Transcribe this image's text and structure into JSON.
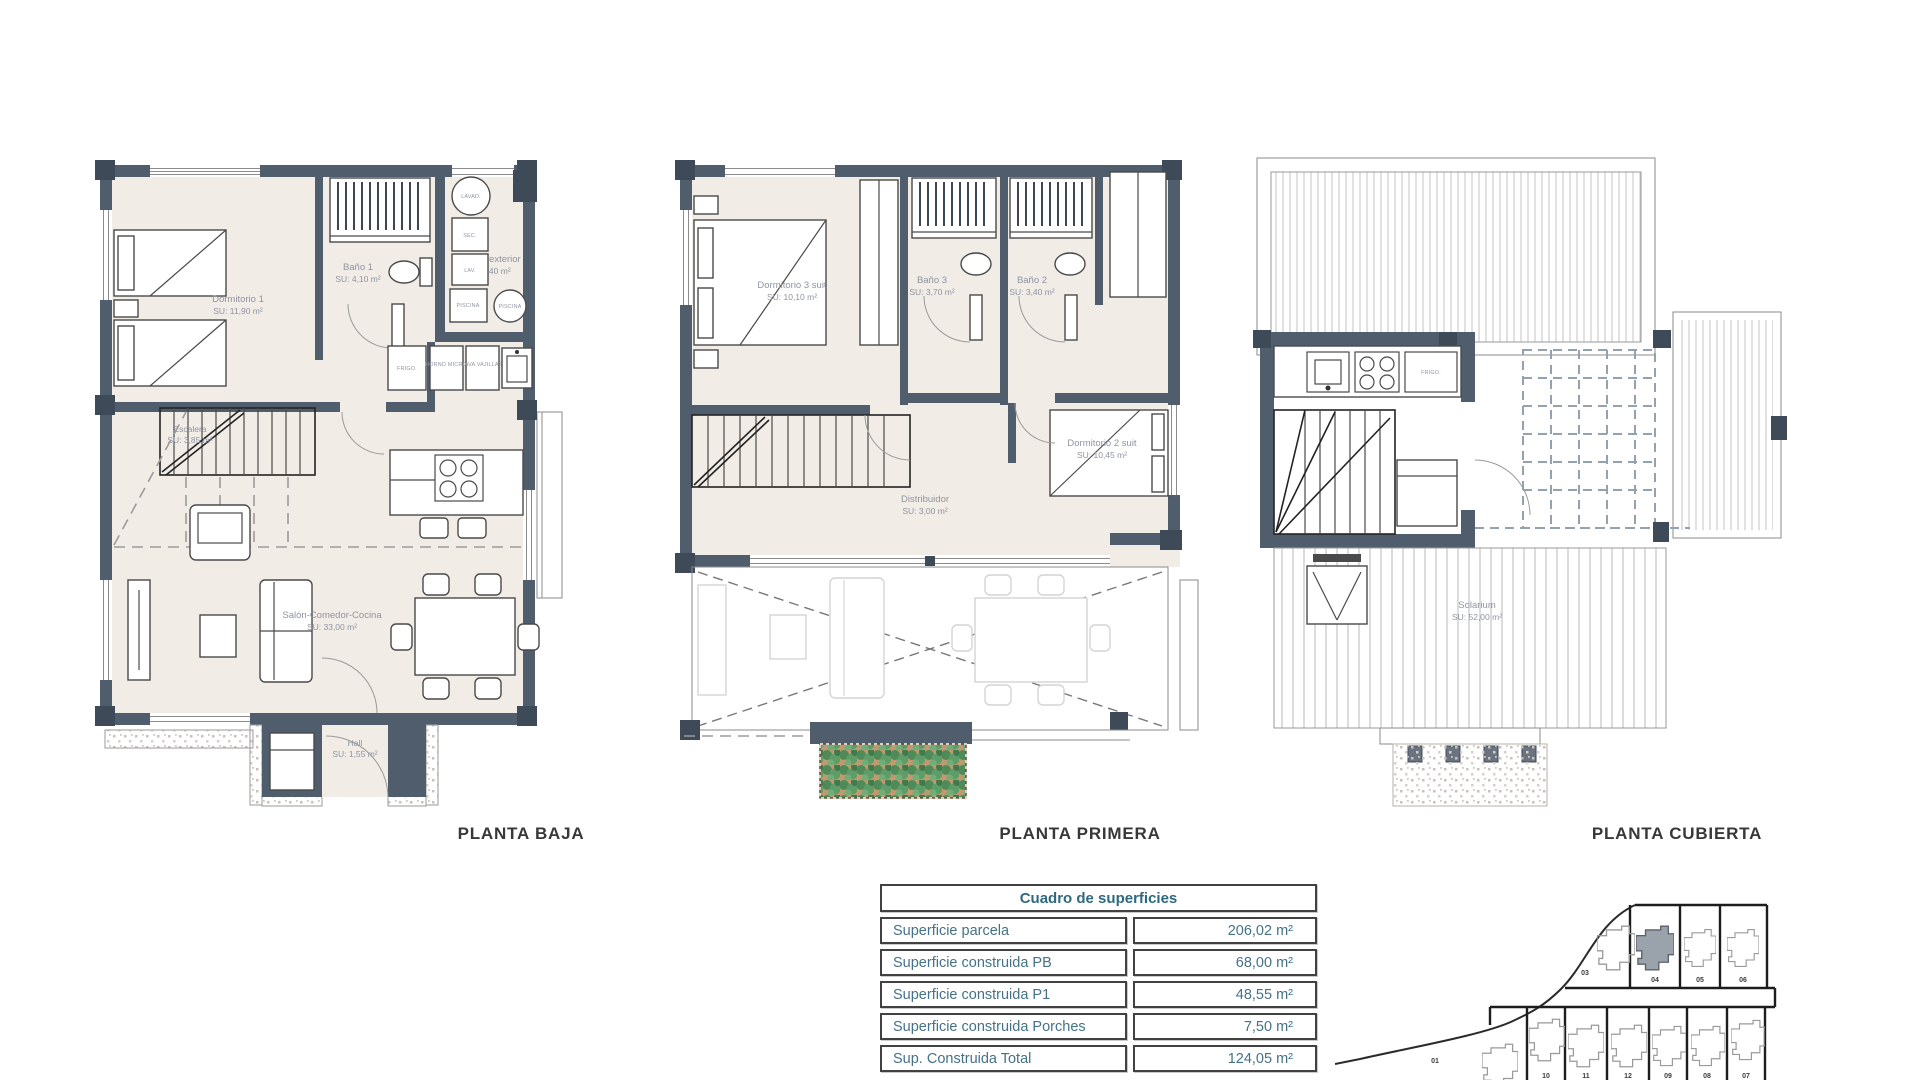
{
  "document_title": "Floor plan sheet",
  "colors": {
    "wall": "#505d6c",
    "floor": "#f2ece7",
    "table_text": "#457285",
    "table_header_text": "#2e6a7e",
    "title_text": "#383838",
    "room_label_text": "#8e94a2",
    "plant_green": "#4f8a59",
    "planter_soil": "#c1996f",
    "highlight_plot": "#9aa2ac"
  },
  "plans": [
    {
      "id": "planta-baja",
      "title": "PLANTA BAJA",
      "rooms": [
        {
          "name": "Dormitorio 1",
          "area": "SU: 11,90 m²"
        },
        {
          "name": "Baño 1",
          "area": "SU: 4,10 m²"
        },
        {
          "name": "Galería exterior",
          "area": "SU: 3,40 m²"
        },
        {
          "name": "Escalera",
          "area": "SU: 3,85 m²"
        },
        {
          "name": "Salón-Comedor-Cocina",
          "area": "SU: 33,00 m²"
        },
        {
          "name": "Hall",
          "area": "SU: 1,55 m²"
        }
      ],
      "labels": {
        "frigo": "FRIGO.",
        "horno": "HORNO MICRO",
        "lavavajillas": "LAVA VAJILLAS",
        "lavadora": "LAVAD.",
        "secadora": "SEC.",
        "lav": "LAV.",
        "piscina1": "PISCINA",
        "piscina2": "PISCINA"
      }
    },
    {
      "id": "planta-primera",
      "title": "PLANTA PRIMERA",
      "rooms": [
        {
          "name": "Dormitorio 3 suit",
          "area": "SU: 10,10 m²"
        },
        {
          "name": "Baño 3",
          "area": "SU: 3,70 m²"
        },
        {
          "name": "Baño 2",
          "area": "SU: 3,40 m²"
        },
        {
          "name": "Dormitorio 2 suit",
          "area": "SU: 10,45 m²"
        },
        {
          "name": "Distribuidor",
          "area": "SU: 3,00 m²"
        }
      ]
    },
    {
      "id": "planta-cubierta",
      "title": "PLANTA CUBIERTA",
      "rooms": [
        {
          "name": "Solarium",
          "area": "SU: 52,00 m²"
        }
      ],
      "labels": {
        "frigo": "FRIGO."
      }
    }
  ],
  "surfaces_table": {
    "header": "Cuadro de superficies",
    "rows": [
      {
        "label": "Superficie parcela",
        "value": "206,02 m²"
      },
      {
        "label": "Superficie construida PB",
        "value": "68,00 m²"
      },
      {
        "label": "Superficie construida P1",
        "value": "48,55 m²"
      },
      {
        "label": "Superficie construida Porches",
        "value": "7,50 m²"
      },
      {
        "label": "Sup. Construida Total",
        "value": "124,05 m²"
      }
    ]
  },
  "site_plan": {
    "highlighted_plot": "04",
    "plots": [
      "03",
      "04",
      "05",
      "06",
      "01",
      "10",
      "11",
      "12",
      "09",
      "08",
      "07"
    ]
  }
}
